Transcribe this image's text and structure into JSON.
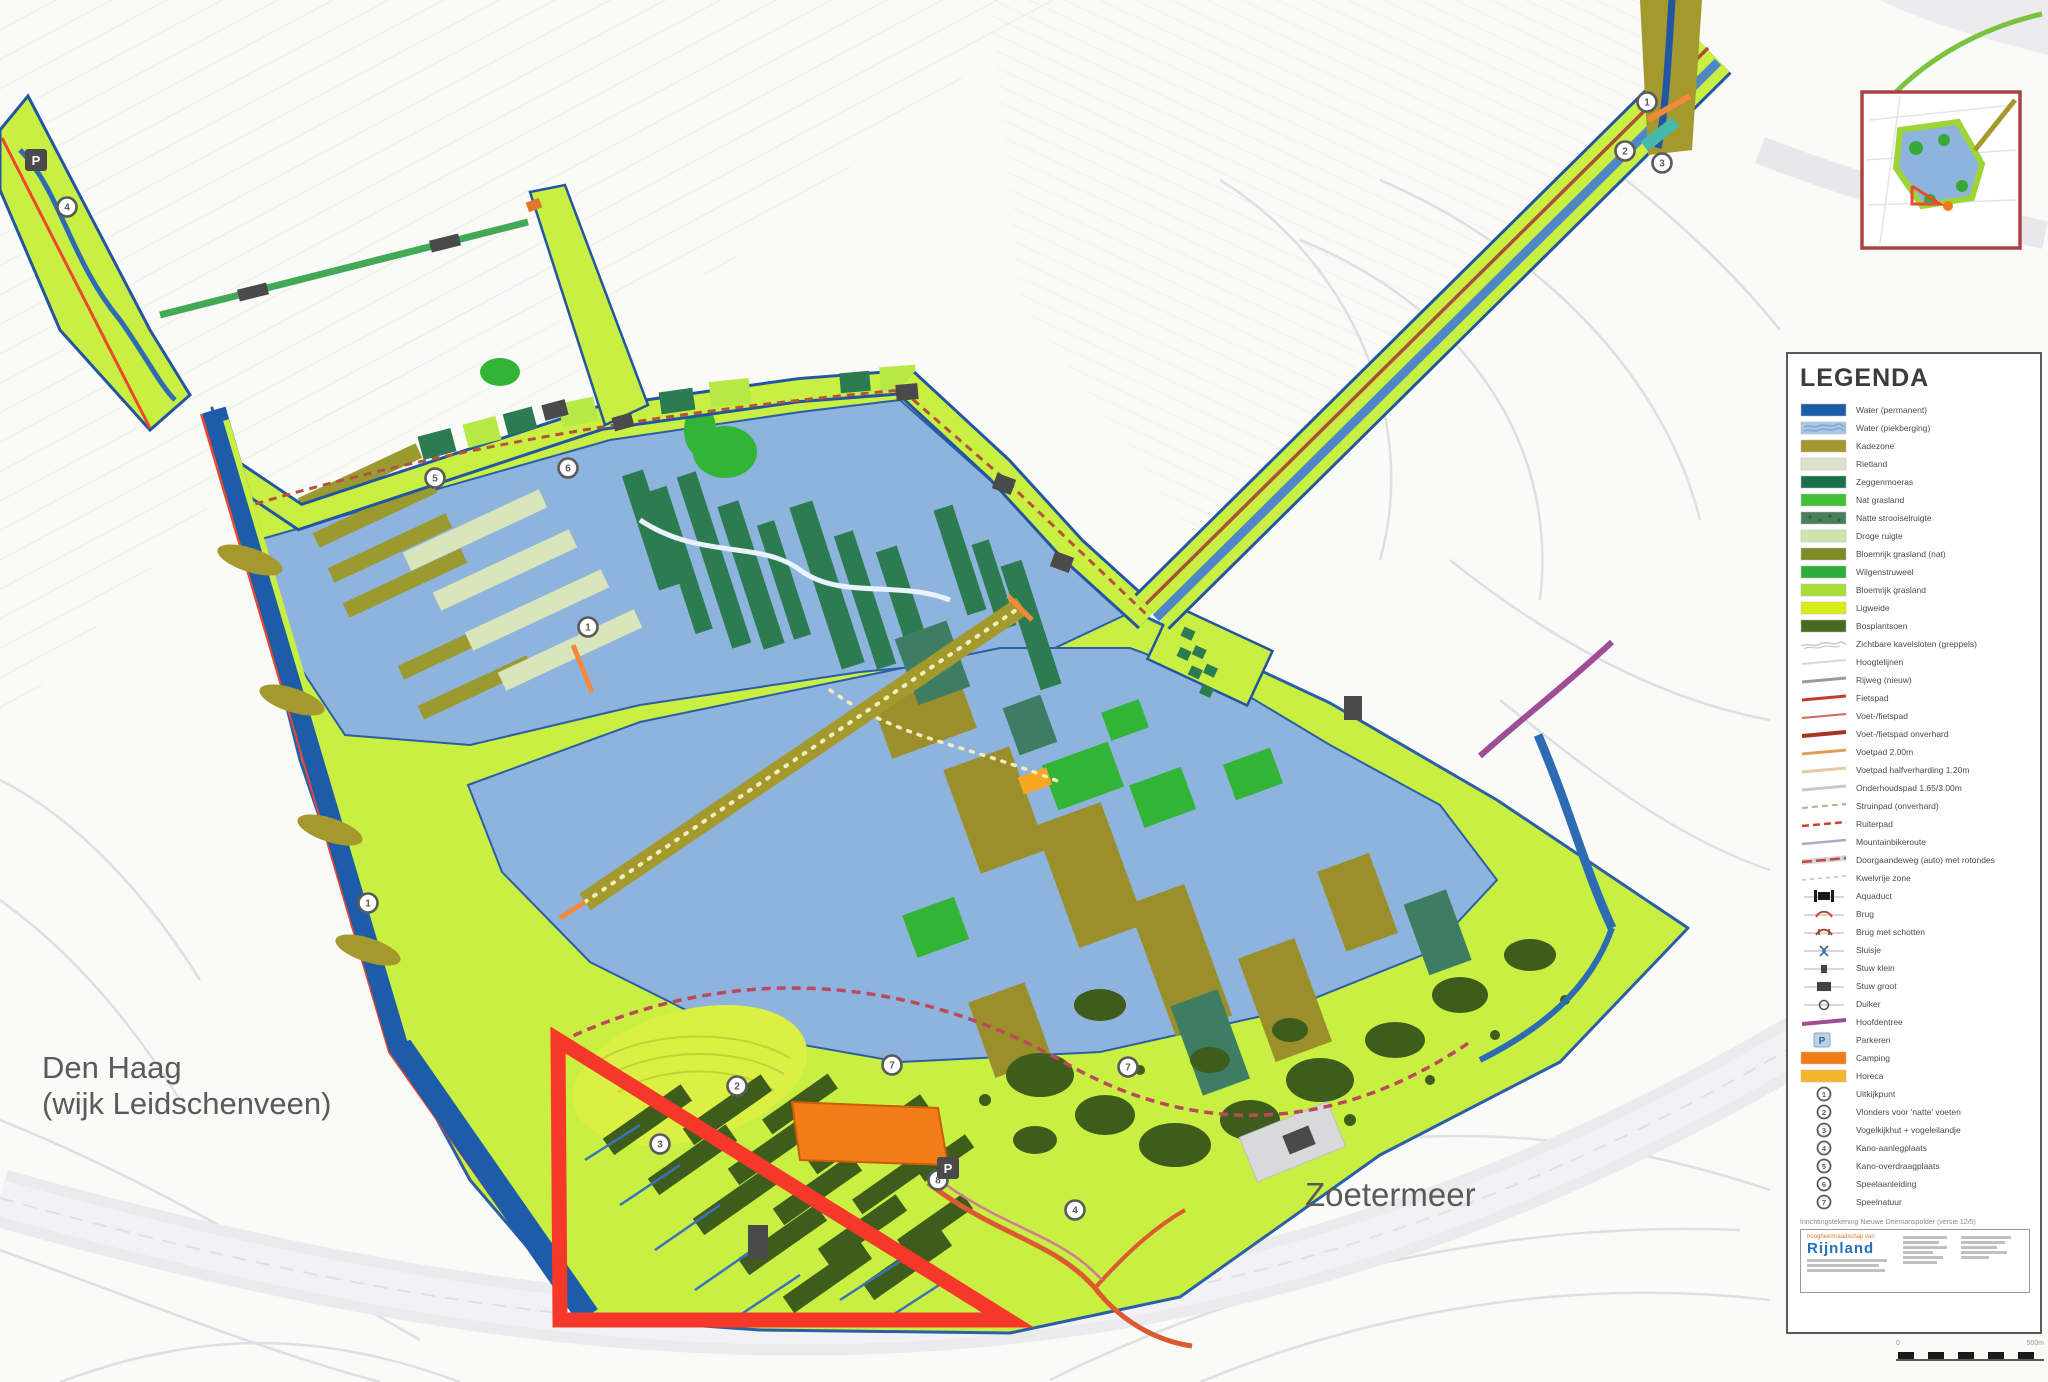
{
  "map": {
    "city_labels": {
      "den_haag_line1": "Den Haag",
      "den_haag_line2": "(wijk Leidschenveen)",
      "zoetermeer": "Zoetermeer"
    },
    "parking_label": "P",
    "number_markers": [
      {
        "x": 67,
        "y": 207,
        "n": "4"
      },
      {
        "x": 435,
        "y": 478,
        "n": "5"
      },
      {
        "x": 568,
        "y": 468,
        "n": "6"
      },
      {
        "x": 588,
        "y": 627,
        "n": "1"
      },
      {
        "x": 368,
        "y": 903,
        "n": "1"
      },
      {
        "x": 737,
        "y": 1086,
        "n": "2"
      },
      {
        "x": 660,
        "y": 1144,
        "n": "3"
      },
      {
        "x": 892,
        "y": 1065,
        "n": "7"
      },
      {
        "x": 938,
        "y": 1180,
        "n": "8"
      },
      {
        "x": 1075,
        "y": 1210,
        "n": "4"
      },
      {
        "x": 1128,
        "y": 1067,
        "n": "7"
      },
      {
        "x": 1647,
        "y": 102,
        "n": "1"
      },
      {
        "x": 1625,
        "y": 151,
        "n": "2"
      },
      {
        "x": 1662,
        "y": 163,
        "n": "3"
      }
    ],
    "parking_markers": [
      {
        "x": 36,
        "y": 160
      },
      {
        "x": 948,
        "y": 1168
      }
    ],
    "colors": {
      "water_permanent": "#1f5ca6",
      "water_piekberging": "#8fb4dc",
      "kade": "#a3992f",
      "park_band": "#c9ee45",
      "tree_dark": "#3f5c1d",
      "moeras_teal": "#2e7a52",
      "camping_orange": "#ef7d1a",
      "boundary_red": "#f2392c",
      "inset_border": "#a84444"
    }
  },
  "legend": {
    "title": "LEGENDA",
    "areas": [
      {
        "label": "Water (permanent)",
        "color": "#1f5ca6"
      },
      {
        "label": "Water (piekberging)",
        "color": "#a9c8e6",
        "pattern": "waves"
      },
      {
        "label": "Kadezone",
        "color": "#a3992f"
      },
      {
        "label": "Rietland",
        "color": "#dde2cd"
      },
      {
        "label": "Zeggenmoeras",
        "color": "#1d6f4e"
      },
      {
        "label": "Nat grasland",
        "color": "#45c03a"
      },
      {
        "label": "Natte strooiselruigte",
        "color": "#4b7f5c",
        "pattern": "mottle"
      },
      {
        "label": "Droge ruigte",
        "color": "#cfe3ae"
      },
      {
        "label": "Bloemrijk grasland (nat)",
        "color": "#7f8c26"
      },
      {
        "label": "Wilgenstruweel",
        "color": "#2fae3c"
      },
      {
        "label": "Bloemrijk grasland",
        "color": "#a8dc3a"
      },
      {
        "label": "Ligweide",
        "color": "#d6ec1e"
      },
      {
        "label": "Bosplantsoen",
        "color": "#476b22"
      }
    ],
    "lines": [
      {
        "label": "Zichtbare kavelsloten (greppels)",
        "type": "wavy",
        "color": "#c8c8cc"
      },
      {
        "label": "Hoogtelijnen",
        "type": "line",
        "color": "#d8d8da",
        "width": 2
      },
      {
        "label": "Rijweg (nieuw)",
        "type": "line",
        "color": "#9a9aa0",
        "width": 3
      },
      {
        "label": "Fietspad",
        "type": "line",
        "color": "#c23b2f",
        "width": 3
      },
      {
        "label": "Voet-/fietspad",
        "type": "line",
        "color": "#d4685c",
        "width": 2
      },
      {
        "label": "Voet-/fietspad onverhard",
        "type": "line",
        "color": "#a63326",
        "width": 4
      },
      {
        "label": "Voetpad 2.00m",
        "type": "line",
        "color": "#d9a05a",
        "width": 3
      },
      {
        "label": "Voetpad halfverharding 1.20m",
        "type": "line",
        "color": "#e4c9a0",
        "width": 3
      },
      {
        "label": "Onderhoudspad 1.65/3.00m",
        "type": "line",
        "color": "#c9c9cc",
        "width": 3
      },
      {
        "label": "Struinpad (onverhard)",
        "type": "line",
        "color": "#9bbf8a",
        "width": 2,
        "dash": "6 4"
      },
      {
        "label": "Ruiterpad",
        "type": "line",
        "color": "#c2452f",
        "width": 2.5,
        "dash": "7 4"
      },
      {
        "label": "Mountainbikeroute",
        "type": "line",
        "color": "#b0aac6",
        "width": 2.5
      },
      {
        "label": "Doorgaandeweg (auto) met rotondes",
        "type": "line",
        "color": "#c24545",
        "width": 2.5,
        "dash": "10 4",
        "casing": "#d5d5d8"
      },
      {
        "label": "Kwelvrije zone",
        "type": "line",
        "color": "#bfbfc4",
        "width": 1.5,
        "dash": "4 4"
      },
      {
        "label": "Aquaduct",
        "type": "icon",
        "icon": "aquaduct"
      },
      {
        "label": "Brug",
        "type": "icon",
        "icon": "brug"
      },
      {
        "label": "Brug met schotten",
        "type": "icon",
        "icon": "brug2"
      },
      {
        "label": "Sluisje",
        "type": "icon",
        "icon": "sluis"
      },
      {
        "label": "Stuw klein",
        "type": "icon",
        "icon": "stuwk"
      },
      {
        "label": "Stuw groot",
        "type": "icon",
        "icon": "stuwg"
      },
      {
        "label": "Duiker",
        "type": "icon",
        "icon": "duiker"
      },
      {
        "label": "Hoofdentree",
        "type": "line",
        "color": "#9c4f96",
        "width": 4
      }
    ],
    "points": [
      {
        "label": "Parkeren",
        "type": "pmark"
      },
      {
        "label": "Camping",
        "type": "swatch",
        "color": "#ef7d1a"
      },
      {
        "label": "Horeca",
        "type": "swatch",
        "color": "#f2b52a"
      }
    ],
    "numbered": [
      {
        "n": "1",
        "label": "Uitkijkpunt"
      },
      {
        "n": "2",
        "label": "Vlonders voor 'natte' voeten"
      },
      {
        "n": "3",
        "label": "Vogelkijkhut + vogeleilandje"
      },
      {
        "n": "4",
        "label": "Kano-aanlegplaats"
      },
      {
        "n": "5",
        "label": "Kano-overdraagplaats"
      },
      {
        "n": "6",
        "label": "Speelaanleiding"
      },
      {
        "n": "7",
        "label": "Speelnatuur"
      }
    ],
    "footer": {
      "doc_line": "Inrichtingstekening Nieuwe Driemanspolder (versie 12/5)",
      "org_small": "hoogheemraadschap van",
      "org": "Rijnland",
      "scale_start": "0",
      "scale_end": "500m"
    }
  }
}
